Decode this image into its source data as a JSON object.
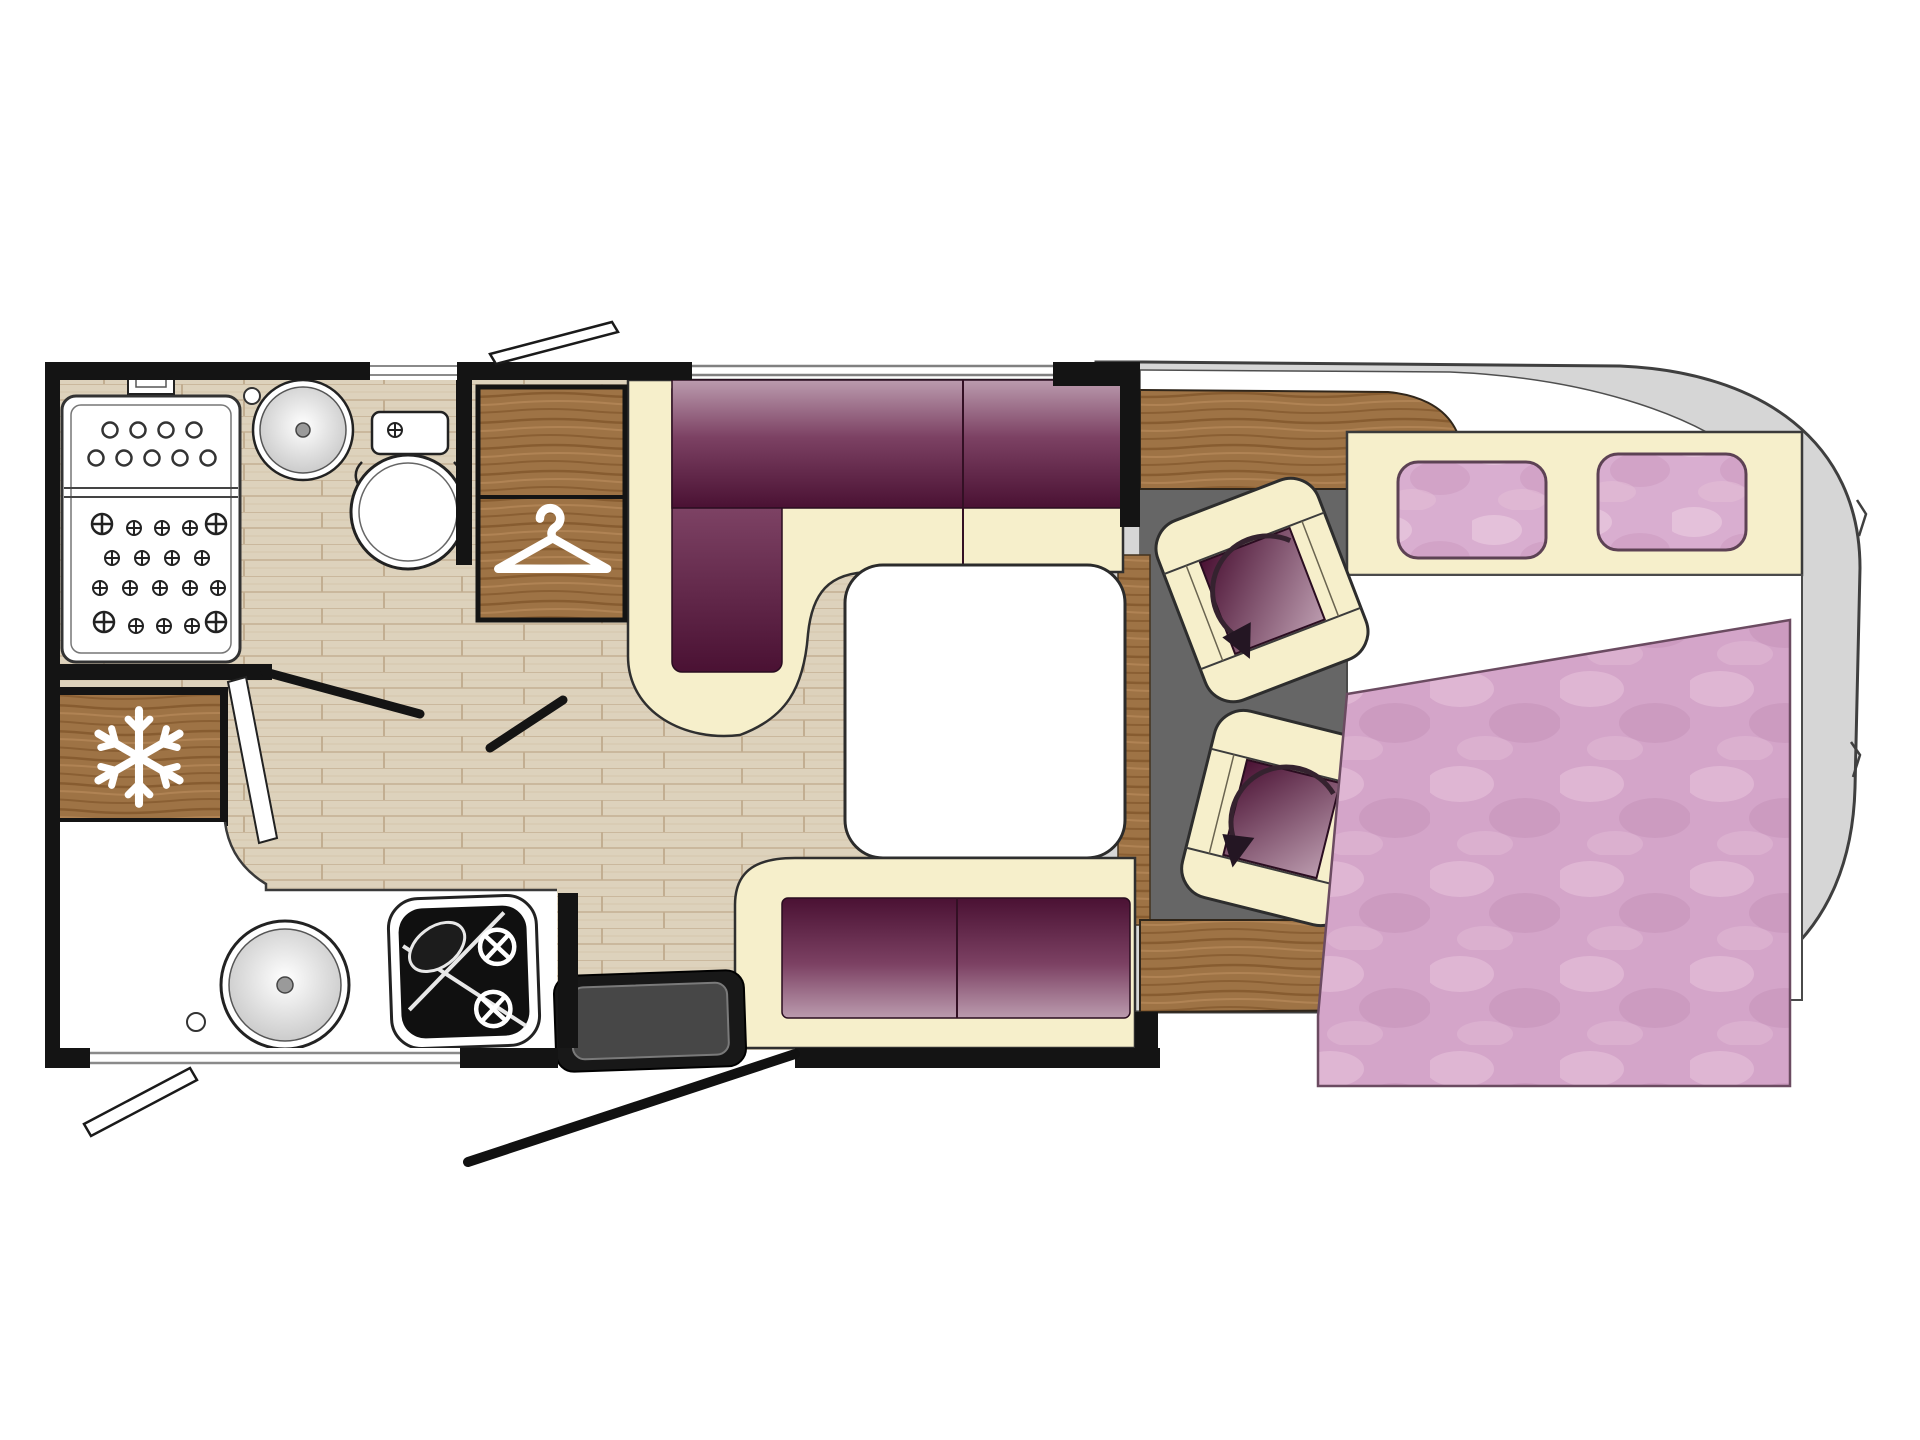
{
  "page": {
    "title": "Motorhome floor plan – top-down layout drawing"
  },
  "floorplan": {
    "vehicle_type": "motorhome / camper van",
    "view": "top-down",
    "zones": [
      {
        "name": "bathroom",
        "features": [
          "shower tray with drain holes",
          "round washbasin",
          "toilet with cistern",
          "hinged bathroom door"
        ]
      },
      {
        "name": "wardrobe",
        "features": [
          "two wood compartments",
          "clothes hanger symbol"
        ]
      },
      {
        "name": "refrigerator",
        "features": [
          "wood door",
          "snowflake symbol"
        ]
      },
      {
        "name": "kitchen",
        "features": [
          "white worktop",
          "round sink",
          "gas hob with burners",
          "end wall"
        ]
      },
      {
        "name": "dinette",
        "features": [
          "L-shaped plum sofa with cream trim",
          "white pedestal table",
          "plum side bench"
        ]
      },
      {
        "name": "cab",
        "features": [
          "dark cab floor",
          "curved wood dashboard",
          "two swivel seats with rotation arrows"
        ]
      },
      {
        "name": "bedroom",
        "features": [
          "cream headboard shelf",
          "two pink pillows",
          "double bed with pink duvet"
        ]
      },
      {
        "name": "entrance",
        "features": [
          "entry step",
          "door swing line",
          "window swing bars"
        ]
      }
    ],
    "icons": [
      {
        "name": "snowflake-icon",
        "meaning": "refrigerator / freezer"
      },
      {
        "name": "hanger-icon",
        "meaning": "wardrobe"
      },
      {
        "name": "swivel-arrow-icon",
        "meaning": "rotating cab seat"
      },
      {
        "name": "burner-icon",
        "meaning": "gas hob burner"
      }
    ],
    "colors": {
      "wall": "#141414",
      "cream_upholstery": "#f6efcb",
      "plum_dark": "#4a1133",
      "plum_mid": "#7c4163",
      "plum_light": "#bb9bae",
      "pillow_pink": "#d9aed0",
      "duvet_pink": "#d4a5c9",
      "wood": "#9e7345",
      "floor_planks": "#ddd2bc",
      "cab_floor": "#666666",
      "vehicle_body": "#d6d6d6"
    }
  }
}
